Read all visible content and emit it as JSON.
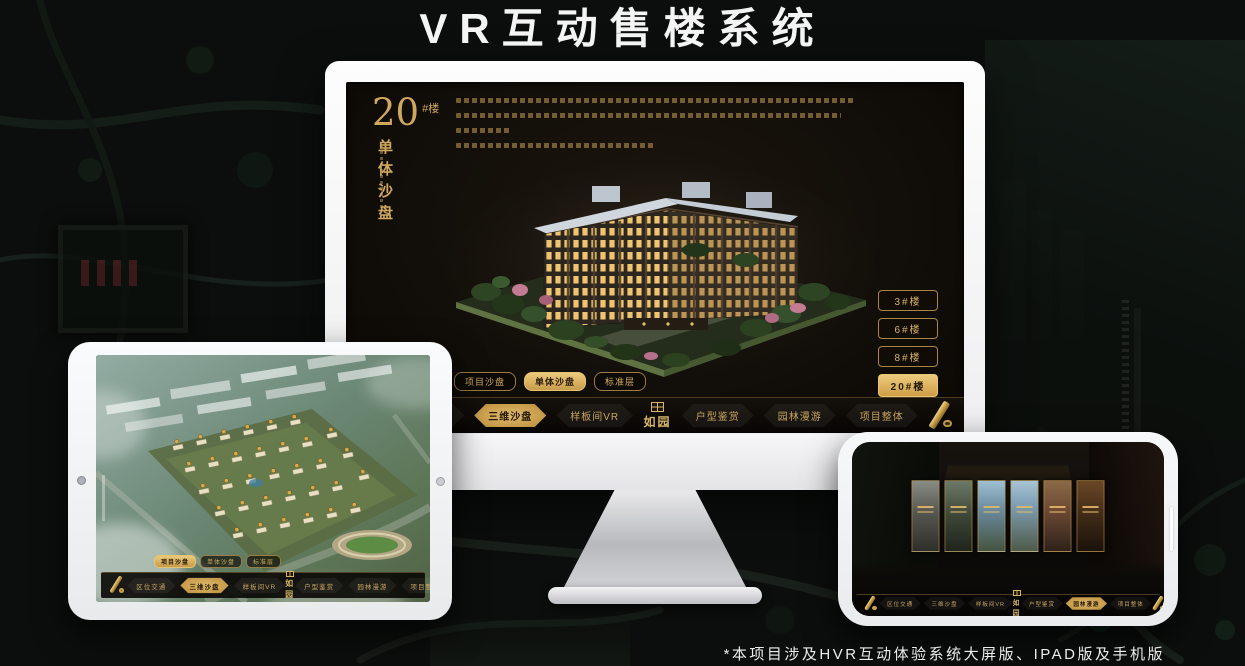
{
  "page": {
    "title": "VR互动售楼系统",
    "footnote": "*本项目涉及HVR互动体验系统大屏版、IPAD版及手机版"
  },
  "brand": {
    "name": "如园",
    "colors": {
      "gold": "#D2A85C",
      "gold_active": "#D9B565",
      "nav_background": "#0B0906",
      "screen_background": "#15110B"
    },
    "icons": {
      "seal-icon": "stamp-square",
      "scroll-ornament": "rolled-gold-scroll"
    }
  },
  "monitor_app": {
    "floor_title": {
      "number": "20",
      "unit": "#楼",
      "subtitle": "单体沙盘"
    },
    "building_buttons": [
      {
        "label": "3#楼"
      },
      {
        "label": "6#楼"
      },
      {
        "label": "8#楼"
      },
      {
        "label": "20#楼",
        "active": true
      }
    ],
    "sub_tabs": [
      {
        "label": "项目沙盘"
      },
      {
        "label": "单体沙盘",
        "active": true
      },
      {
        "label": "标准层"
      }
    ],
    "nav_left": [
      {
        "label": "区位交通"
      },
      {
        "label": "三维沙盘",
        "active": true
      },
      {
        "label": "样板间VR"
      }
    ],
    "nav_right": [
      {
        "label": "户型鉴赏"
      },
      {
        "label": "园林漫游"
      },
      {
        "label": "项目整体"
      }
    ]
  },
  "ipad_app": {
    "sub_tabs": [
      {
        "label": "项目沙盘",
        "active": true
      },
      {
        "label": "单体沙盘"
      },
      {
        "label": "标准层"
      }
    ],
    "nav_left": [
      {
        "label": "区位交通"
      },
      {
        "label": "三维沙盘",
        "active": true
      },
      {
        "label": "样板间VR"
      }
    ],
    "nav_right": [
      {
        "label": "户型鉴赏"
      },
      {
        "label": "园林漫游"
      },
      {
        "label": "项目整体"
      }
    ]
  },
  "phone_app": {
    "nav_left": [
      {
        "label": "区位交通"
      },
      {
        "label": "三维沙盘"
      },
      {
        "label": "样板间VR"
      }
    ],
    "nav_right": [
      {
        "label": "户型鉴赏"
      },
      {
        "label": "园林漫游",
        "active": true
      },
      {
        "label": "项目整体"
      }
    ],
    "scene_panel_count": 6
  }
}
